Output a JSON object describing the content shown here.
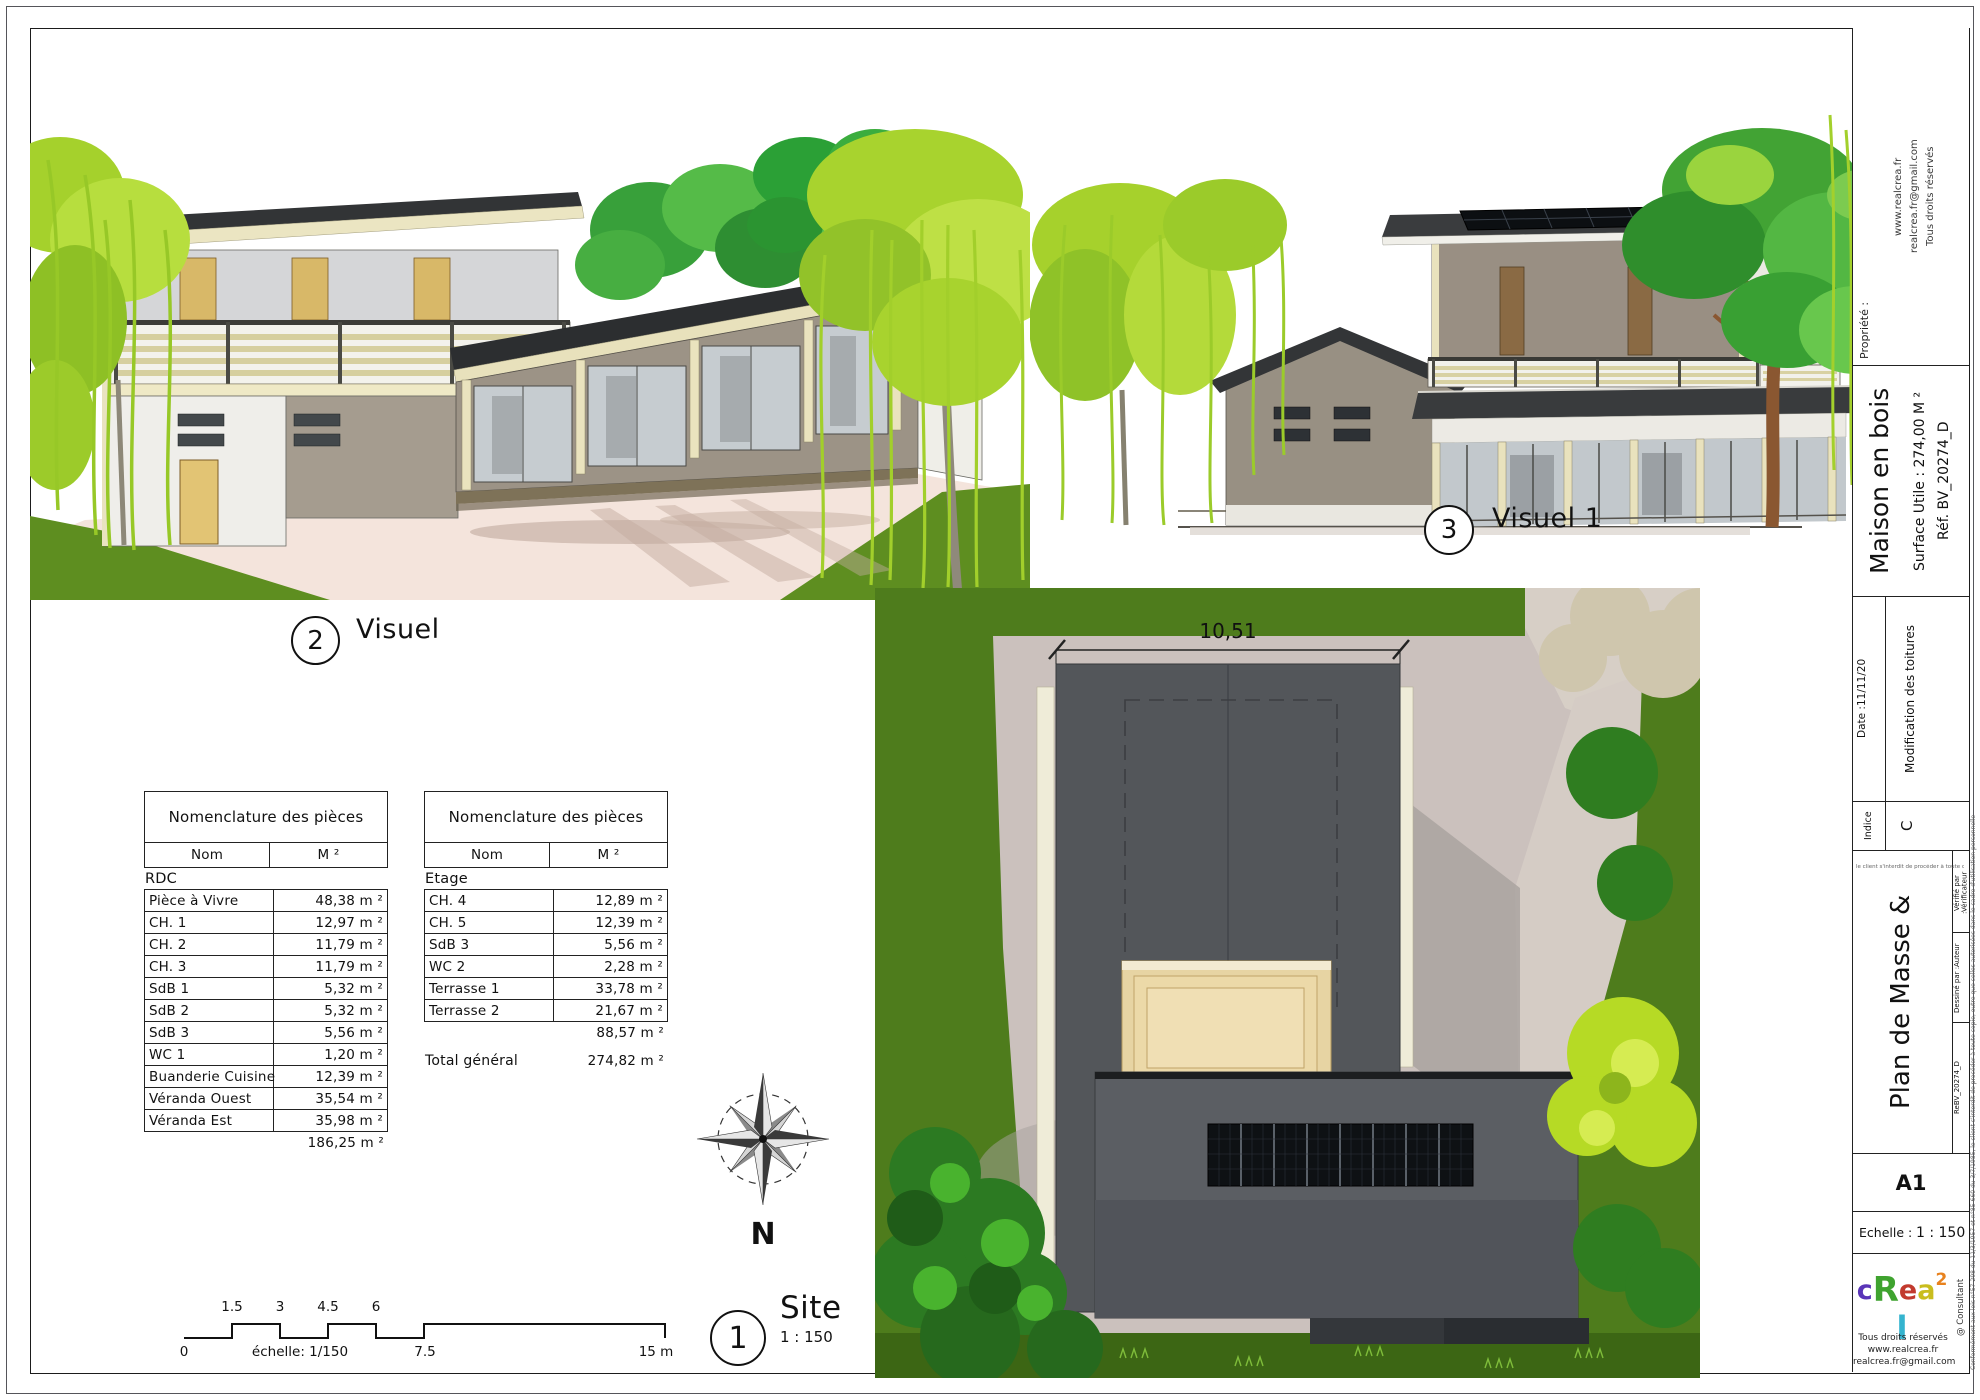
{
  "labels": {
    "visual2": {
      "number": "2",
      "title": "Visuel"
    },
    "visual1": {
      "number": "3",
      "title": "Visuel 1"
    },
    "site": {
      "number": "1",
      "title": "Site",
      "scale": "1 : 150"
    }
  },
  "site_plan": {
    "width_dimension": "10,51",
    "north_label": "N"
  },
  "scale_bar": {
    "top": [
      "1.5",
      "3",
      "4.5",
      "6"
    ],
    "bottom": [
      "0",
      "échelle: 1/150",
      "7.5",
      "15 m"
    ]
  },
  "nomenclature_rdc": {
    "title": "Nomenclature des pièces",
    "col_nom": "Nom",
    "col_m2": "M ²",
    "group": "RDC",
    "rows": [
      {
        "nom": "Pièce à Vivre",
        "m2": "48,38 m ²"
      },
      {
        "nom": "CH. 1",
        "m2": "12,97 m ²"
      },
      {
        "nom": "CH. 2",
        "m2": "11,79 m ²"
      },
      {
        "nom": "CH. 3",
        "m2": "11,79 m ²"
      },
      {
        "nom": "SdB 1",
        "m2": "5,32 m ²"
      },
      {
        "nom": "SdB 2",
        "m2": "5,32 m ²"
      },
      {
        "nom": "SdB 3",
        "m2": "5,56 m ²"
      },
      {
        "nom": "WC 1",
        "m2": "1,20 m ²"
      },
      {
        "nom": "Buanderie Cuisine",
        "m2": "12,39 m ²"
      },
      {
        "nom": "Véranda Ouest",
        "m2": "35,54 m ²"
      },
      {
        "nom": "Véranda Est",
        "m2": "35,98 m ²"
      }
    ],
    "total": "186,25 m ²"
  },
  "nomenclature_etage": {
    "title": "Nomenclature des pièces",
    "col_nom": "Nom",
    "col_m2": "M ²",
    "group": "Etage",
    "rows": [
      {
        "nom": "CH. 4",
        "m2": "12,89 m ²"
      },
      {
        "nom": "CH. 5",
        "m2": "12,39 m ²"
      },
      {
        "nom": "SdB 3",
        "m2": "5,56 m ²"
      },
      {
        "nom": "WC 2",
        "m2": "2,28 m ²"
      },
      {
        "nom": "Terrasse 1",
        "m2": "33,78 m ²"
      },
      {
        "nom": "Terrasse 2",
        "m2": "21,67 m ²"
      }
    ],
    "subtotal": "88,57 m ²",
    "total_label": "Total général",
    "total": "274,82 m ²"
  },
  "title_block": {
    "propriete_label": "Propriété :",
    "contact_lines": [
      "www.realcrea.fr",
      "realcrea.fr@gmail.com",
      "Tous droits réservés"
    ],
    "project_title": "Maison en bois",
    "surface": "Surface Utile : 274,00 M ²",
    "reference": "Réf. BV_20274_D",
    "indice_label": "Indice",
    "indice_value": "C",
    "date_label": "Date :",
    "date_value": "11/11/20",
    "revision_note": "Modification des toitures",
    "sheet_title": "Plan de Masse & Visuels",
    "ref_small": "ReBV_20274_D",
    "drawn_by_label": "Dessiné par :",
    "drawn_by_value": "Auteur",
    "checked_by_label": "Vérifié par :",
    "checked_by_value": "Vérificateur",
    "format": "A1",
    "scale_label": "Echelle :",
    "scale_value": "1 : 150",
    "logo_letters": [
      {
        "ch": "c",
        "color": "#5a35b8"
      },
      {
        "ch": "R",
        "color": "#3fa32f"
      },
      {
        "ch": "e",
        "color": "#c23a2e"
      },
      {
        "ch": "a",
        "color": "#c9bd1e"
      },
      {
        "ch": "2",
        "color": "#e8821e"
      },
      {
        "ch": "l",
        "color": "#35b4cf"
      }
    ],
    "consultant": "@ Consultant",
    "copyright_lines": [
      "Tous droits réservés",
      "www.realcrea.fr",
      "realcrea.fr@gmail.com"
    ],
    "legal_bottom": "le client s'interdit de procéder à toute copie, outre que celles autorisées dans le cadre d'utilisation personnelle",
    "legal_edge": "Conformément aux lois n°57-298 du 11/3/1957 et n°85-660 du 3/7/1985, le client s'interdit de procéder à toute copie, outre que celles autorisées dans le cadre d'utilisation personnelle"
  },
  "palette": {
    "roof_dark": "#333537",
    "wall_taupe": "#998f83",
    "wood_cream": "#e9e2bd",
    "willow_green": "#a6d12c",
    "tree_green": "#42a334",
    "lawn_green": "#4e7c1c",
    "paving_pink": "#cbc1bd",
    "solar_black": "#0c0f12"
  }
}
